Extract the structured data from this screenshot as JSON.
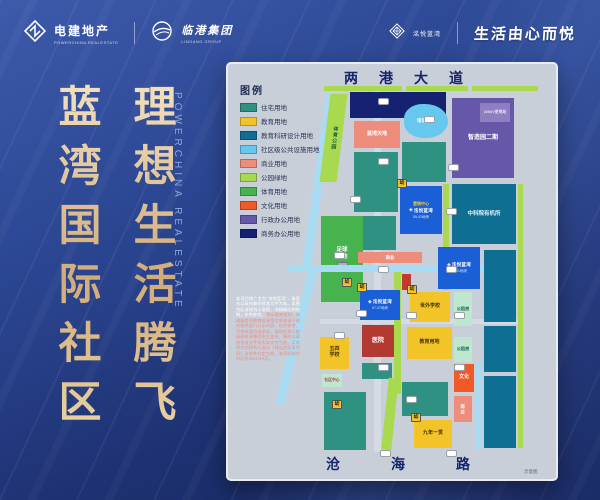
{
  "header": {
    "powerchina_name": "电建地产",
    "powerchina_sub": "POWERCHINA REALESTATE",
    "lingang_name": "临港集团",
    "lingang_sub": "LINGANG GROUP",
    "badge_name": "洺悦蓝湾",
    "slogan": "生活由心而悦"
  },
  "hero": {
    "col1": "蓝湾国际社区",
    "col2": "理想生活腾飞",
    "watermark": "POWERCHINA REALESTATE"
  },
  "map": {
    "legend_title": "图例",
    "legend": [
      {
        "label": "住宅用地",
        "color": "#2f9181"
      },
      {
        "label": "教育用地",
        "color": "#f2c428"
      },
      {
        "label": "教育科研设计用地",
        "color": "#0e6f93"
      },
      {
        "label": "社区级公共设施用地",
        "color": "#66c8ee"
      },
      {
        "label": "商业用地",
        "color": "#ef8d7d"
      },
      {
        "label": "公园绿地",
        "color": "#a8d94e"
      },
      {
        "label": "体育用地",
        "color": "#46b34e"
      },
      {
        "label": "文化用地",
        "color": "#ef5a28"
      },
      {
        "label": "行政办公用地",
        "color": "#6757a8"
      },
      {
        "label": "商务办公用地",
        "color": "#152272"
      }
    ],
    "road_top": "两港大道",
    "road_bottom": "沧海路",
    "note": "示意图",
    "plot_logo": "洺悦蓝湾",
    "kindergarten_tag": "幼",
    "marketing_center": "营销中心",
    "disclaimer_white": "本项目推广名为“洺悦蓝湾”，备案名以政府最终核准文件为准。本图为区域规划示意图，非精确比例绘制，仅供参考。",
    "disclaimer_red": "图示相关规划、市政配套及教育资源等信息来源于政府相关部门公示内容，仅供参考，不构成要约或承诺；规划信息可能因政府调整而发生变化，最终以政府批准文件及实际交付为准。买卖双方的权利义务以《商品房买卖合同》及附件约定为准。本资料制作时间为2021年6月。",
    "blocks": [
      {
        "name": "road-v-main",
        "color": "#d6dbe3",
        "x": 146,
        "y": 26,
        "w": 7,
        "h": 362
      },
      {
        "name": "road-h-main",
        "color": "#d6dbe3",
        "x": 92,
        "y": 255,
        "w": 202,
        "h": 5
      },
      {
        "name": "park-strip-top-1",
        "color": "park",
        "x": 96,
        "y": 22,
        "w": 78,
        "h": 5
      },
      {
        "name": "park-strip-top-2",
        "color": "park",
        "x": 178,
        "y": 22,
        "w": 62,
        "h": 5
      },
      {
        "name": "park-strip-top-3",
        "color": "park",
        "x": 244,
        "y": 22,
        "w": 66,
        "h": 5
      },
      {
        "name": "canal-upper",
        "color": "canal",
        "x": 86,
        "y": 28,
        "w": 9,
        "h": 178,
        "rotate": 8
      },
      {
        "name": "canal-lower",
        "color": "canal",
        "x": 64,
        "y": 202,
        "w": 9,
        "h": 140,
        "rotate": 14
      },
      {
        "name": "sports-park-strip",
        "color": "park",
        "x": 97,
        "y": 30,
        "w": 17,
        "h": 88,
        "skew": -7,
        "label": "体育公园",
        "lc": "#1e5c2a",
        "fs": 5,
        "vert": true
      },
      {
        "name": "business-office-block",
        "color": "biz",
        "x": 122,
        "y": 28,
        "w": 96,
        "h": 26
      },
      {
        "name": "zhizaoyuan-phase2",
        "color": "adm",
        "x": 224,
        "y": 34,
        "w": 62,
        "h": 80,
        "label": "智造园二期",
        "lc": "#ffffff",
        "fs": 6
      },
      {
        "name": "substation",
        "color": "#8d7fc0",
        "x": 252,
        "y": 39,
        "w": 30,
        "h": 19,
        "label": "220kV变电站",
        "lc": "#e8e4f4",
        "fs": 3.8
      },
      {
        "name": "pond-training-center",
        "color": "pub",
        "x": 176,
        "y": 40,
        "w": 44,
        "h": 34,
        "r": "45% 55% 52% 48%",
        "label": "培训中心",
        "lc": "#ffffff",
        "fs": 4.5
      },
      {
        "name": "lanwan-tiandi",
        "color": "com",
        "x": 126,
        "y": 57,
        "w": 46,
        "h": 27,
        "label": "蓝湾天地",
        "lc": "#ffffff",
        "fs": 5
      },
      {
        "name": "res-block-1",
        "color": "res",
        "x": 126,
        "y": 88,
        "w": 44,
        "h": 60
      },
      {
        "name": "res-block-2",
        "color": "res",
        "x": 174,
        "y": 78,
        "w": 44,
        "h": 40
      },
      {
        "name": "cas-organic-institute",
        "color": "sci",
        "x": 224,
        "y": 120,
        "w": 64,
        "h": 60,
        "label": "中科院有机所",
        "lc": "#dff2f8",
        "fs": 5.5
      },
      {
        "name": "green-strip-mid",
        "color": "park",
        "x": 215,
        "y": 120,
        "w": 6,
        "h": 106
      },
      {
        "name": "res-block-3",
        "color": "res",
        "x": 126,
        "y": 152,
        "w": 42,
        "h": 34
      },
      {
        "name": "plot-a",
        "color": "plot",
        "x": 172,
        "y": 122,
        "w": 42,
        "h": 48,
        "type": "logo",
        "tag": true,
        "gold": true,
        "id": "05-02地块"
      },
      {
        "name": "football-base",
        "color": "sport",
        "x": 93,
        "y": 152,
        "w": 42,
        "h": 86,
        "label": "足球基地",
        "lc": "#ffffff",
        "fs": 5.5,
        "two": true,
        "icon": true
      },
      {
        "name": "biz-street",
        "color": "com",
        "x": 130,
        "y": 188,
        "w": 64,
        "h": 11,
        "label": "商业",
        "lc": "#ffffff",
        "fs": 4.5
      },
      {
        "name": "canal-horizontal",
        "color": "canal",
        "x": 60,
        "y": 201,
        "w": 196,
        "h": 7
      },
      {
        "name": "green-s-strip",
        "color": "park",
        "x": 166,
        "y": 208,
        "w": 7,
        "h": 122
      },
      {
        "name": "red-kiosk",
        "color": "#c03c30",
        "x": 174,
        "y": 210,
        "w": 9,
        "h": 16
      },
      {
        "name": "plot-b",
        "color": "plot",
        "x": 210,
        "y": 183,
        "w": 42,
        "h": 42,
        "type": "logo",
        "id": "07-01地块"
      },
      {
        "name": "sci-right-1",
        "color": "sci",
        "x": 256,
        "y": 186,
        "w": 32,
        "h": 72
      },
      {
        "name": "sci-right-2",
        "color": "sci",
        "x": 256,
        "y": 262,
        "w": 32,
        "h": 46
      },
      {
        "name": "sci-right-3",
        "color": "sci",
        "x": 256,
        "y": 312,
        "w": 32,
        "h": 72
      },
      {
        "name": "park-edge-right",
        "color": "park",
        "x": 290,
        "y": 120,
        "w": 5,
        "h": 264
      },
      {
        "name": "plot-c",
        "color": "plot",
        "x": 132,
        "y": 226,
        "w": 40,
        "h": 30,
        "type": "logo",
        "tag": true,
        "id": "07-07地块"
      },
      {
        "name": "shiwai-school",
        "color": "edu",
        "x": 182,
        "y": 228,
        "w": 40,
        "h": 30,
        "label": "世外学校",
        "lc": "#4a3500",
        "fs": 5,
        "tag": true
      },
      {
        "name": "rent-1",
        "color": "rent",
        "x": 226,
        "y": 228,
        "w": 18,
        "h": 34,
        "label": "公租房",
        "lc": "#1c6b50",
        "fs": 4.2
      },
      {
        "name": "hospital",
        "color": "hosp",
        "x": 134,
        "y": 261,
        "w": 32,
        "h": 32,
        "label": "医院",
        "lc": "#ffffff",
        "fs": 6
      },
      {
        "name": "edu-land",
        "color": "edu",
        "x": 179,
        "y": 263,
        "w": 45,
        "h": 32,
        "label": "教育用地",
        "lc": "#4a3500",
        "fs": 5
      },
      {
        "name": "wusi-school",
        "color": "edu",
        "x": 92,
        "y": 273,
        "w": 29,
        "h": 32,
        "label": "五四学校",
        "lc": "#4a3500",
        "fs": 5,
        "two": true
      },
      {
        "name": "rent-2",
        "color": "rent",
        "x": 226,
        "y": 273,
        "w": 18,
        "h": 25,
        "label": "公租房",
        "lc": "#1c6b50",
        "fs": 4.2
      },
      {
        "name": "culture-block",
        "color": "cul",
        "x": 226,
        "y": 300,
        "w": 20,
        "h": 28,
        "label": "文化",
        "lc": "#ffffff",
        "fs": 5
      },
      {
        "name": "biz-strip-2",
        "color": "com",
        "x": 226,
        "y": 332,
        "w": 18,
        "h": 26,
        "label": "商业",
        "lc": "#ffffff",
        "fs": 4.5,
        "vert": true
      },
      {
        "name": "canal-right",
        "color": "canal",
        "x": 247,
        "y": 300,
        "w": 6,
        "h": 86
      },
      {
        "name": "community-center",
        "color": "rent",
        "x": 94,
        "y": 310,
        "w": 20,
        "h": 13,
        "label": "社区中心",
        "lc": "#b04038",
        "fs": 3.8
      },
      {
        "name": "res-block-4",
        "color": "res",
        "x": 96,
        "y": 328,
        "w": 42,
        "h": 58
      },
      {
        "name": "res-block-5",
        "color": "res",
        "x": 174,
        "y": 318,
        "w": 46,
        "h": 34
      },
      {
        "name": "res-block-6",
        "color": "res",
        "x": 134,
        "y": 299,
        "w": 30,
        "h": 16
      },
      {
        "name": "green-diag-bottom",
        "color": "park",
        "x": 157,
        "y": 314,
        "w": 10,
        "h": 72,
        "rotate": 6
      },
      {
        "name": "nine-year-school",
        "color": "edu",
        "x": 186,
        "y": 356,
        "w": 38,
        "h": 28,
        "label": "九年一贯",
        "lc": "#4a3500",
        "fs": 5,
        "tag": true
      }
    ],
    "pills": [
      [
        150,
        34
      ],
      [
        196,
        52
      ],
      [
        150,
        94
      ],
      [
        220,
        100
      ],
      [
        122,
        132
      ],
      [
        218,
        144
      ],
      [
        106,
        188
      ],
      [
        150,
        202
      ],
      [
        218,
        202
      ],
      [
        128,
        246
      ],
      [
        178,
        248
      ],
      [
        226,
        248
      ],
      [
        106,
        268
      ],
      [
        150,
        300
      ],
      [
        226,
        300
      ],
      [
        178,
        332
      ],
      [
        152,
        386
      ],
      [
        218,
        386
      ]
    ],
    "standalone_tags": [
      [
        114,
        214
      ],
      [
        104,
        336
      ]
    ]
  },
  "colors": {
    "residential": "#2f9181",
    "education": "#f2c428",
    "research": "#0e6f93",
    "public": "#66c8ee",
    "commercial": "#ef8d7d",
    "park": "#a8d94e",
    "sport": "#46b34e",
    "culture": "#ef5a28",
    "admin": "#6757a8",
    "business": "#152272",
    "plot_blue": "#1a5fd6",
    "hospital": "#b23a33",
    "rent": "#bfe7d0",
    "canal": "#a9dcf2",
    "gold": "#ddbb8a"
  }
}
